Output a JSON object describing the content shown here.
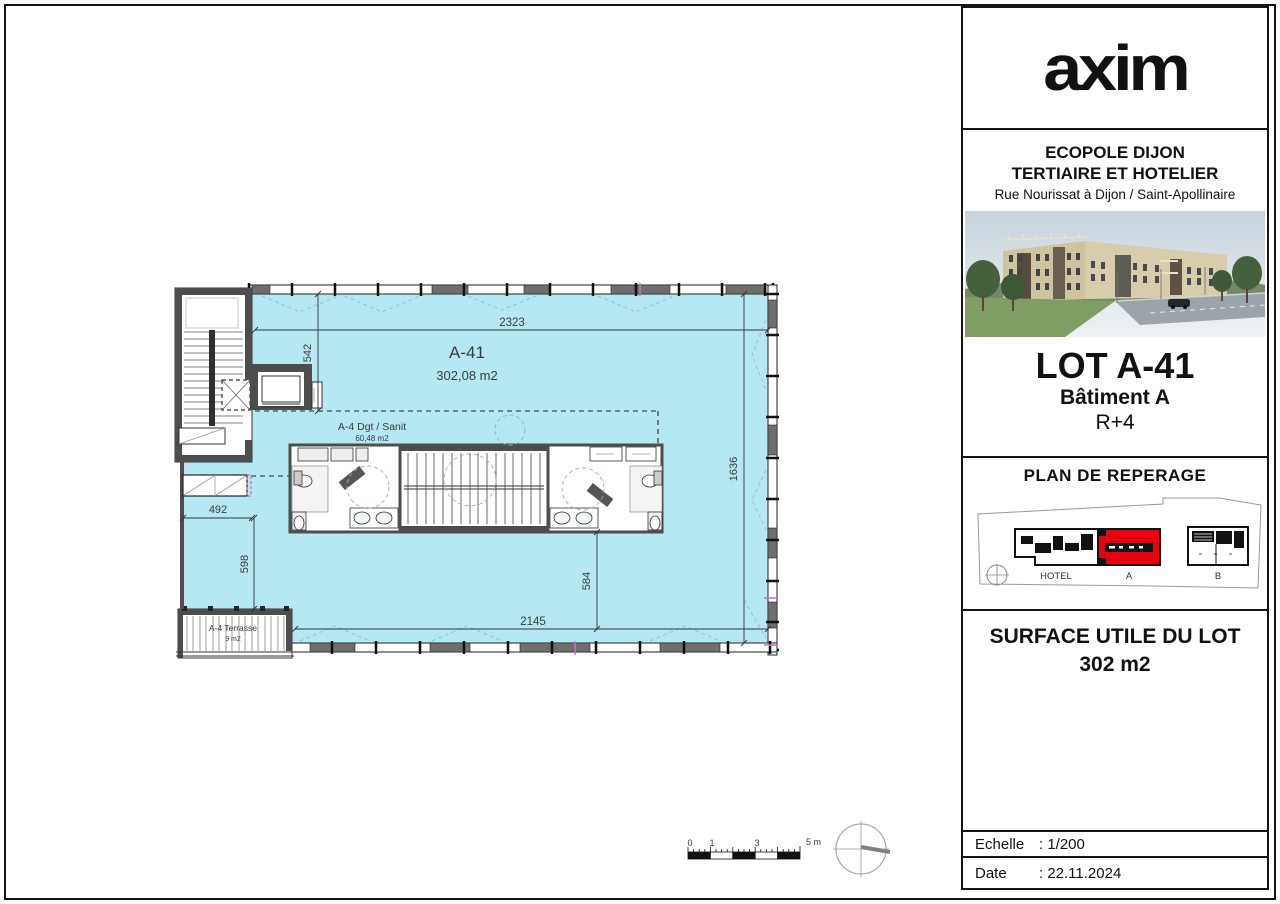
{
  "sidebar": {
    "logo_text": "axim",
    "project": {
      "line1": "ECOPOLE DIJON",
      "line2": "TERTIAIRE ET HOTELIER",
      "address": "Rue Nourissat à Dijon / Saint-Apollinaire"
    },
    "lot": {
      "title": "LOT A-41",
      "building": "Bâtiment A",
      "level": "R+4"
    },
    "reperage": {
      "title": "PLAN DE REPERAGE",
      "hotel_label": "HOTEL",
      "a_label": "A",
      "b_label": "B"
    },
    "surface": {
      "title": "SURFACE UTILE DU LOT",
      "value": "302 m2"
    },
    "scale": {
      "label": "Echelle",
      "value": ": 1/200"
    },
    "date": {
      "label": "Date",
      "value": ": 22.11.2024"
    }
  },
  "plan": {
    "main_room": {
      "name": "A-41",
      "area": "302,08 m2"
    },
    "sanit": {
      "name": "A-4 Dgt / Sanit",
      "area": "60,48 m2"
    },
    "terrace": {
      "name": "A-4 Terrasse",
      "area": "9 m2"
    },
    "dims": {
      "top": "2323",
      "stair_height": "542",
      "right": "1636",
      "left_width": "492",
      "left_height": "598",
      "bottom_inner": "584",
      "bottom": "2145"
    },
    "scalebar": {
      "t0": "0",
      "t1": "1",
      "t3": "3",
      "t5": "5 m"
    }
  },
  "colors": {
    "plan_fill": "#b5e8f3",
    "wall": "#4d4d4d",
    "accent_red": "#e8000f",
    "line": "#2e2e2e"
  }
}
